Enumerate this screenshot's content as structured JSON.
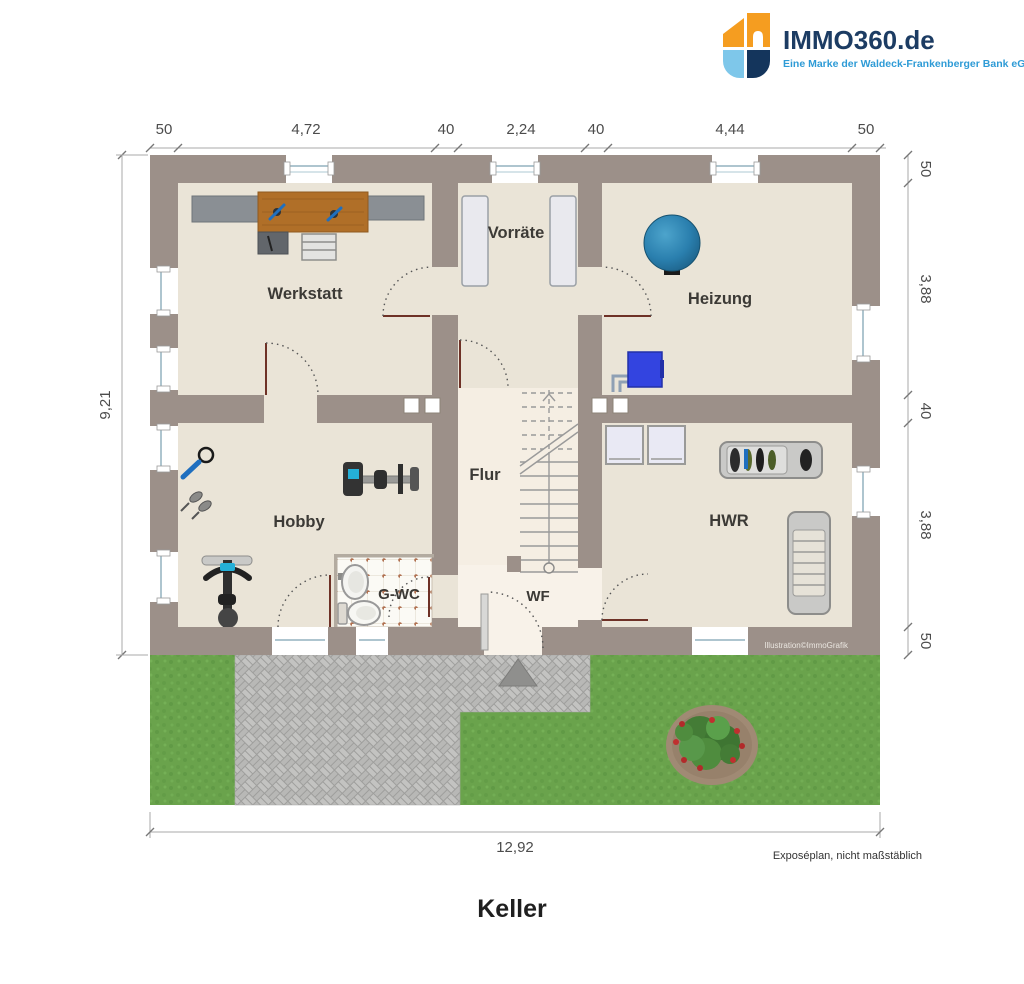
{
  "header": {
    "brand": "IMMO360.de",
    "tagline": "Eine Marke der Waldeck-Frankenberger Bank eG"
  },
  "plan": {
    "rooms": {
      "werkstatt": "Werkstatt",
      "vorraete": "Vorräte",
      "heizung": "Heizung",
      "flur": "Flur",
      "hobby": "Hobby",
      "gwc": "G-WC",
      "wf": "WF",
      "hwr": "HWR"
    },
    "copyright": "Illustration©ImmoGrafik",
    "icons": [
      "storage-tank",
      "boiler",
      "workbench",
      "step-ladder",
      "exercise-bike",
      "rowing-machine",
      "washer",
      "dryer",
      "drying-rack-full",
      "drying-rack-empty",
      "sink",
      "toilet",
      "staircase",
      "entrance-arrow",
      "bush",
      "shelf"
    ]
  },
  "dimensions": {
    "top": [
      "50",
      "4,72",
      "40",
      "2,24",
      "40",
      "4,44",
      "50"
    ],
    "right": [
      "50",
      "3,88",
      "40",
      "3,88",
      "50"
    ],
    "left": [
      "9,21"
    ],
    "bottom": [
      "12,92"
    ]
  },
  "footer": {
    "note": "Exposéplan, nicht maßstäblich",
    "floor_title": "Keller"
  },
  "colors": {
    "brand_navy": "#1c3c63",
    "brand_blue": "#2e9bd6",
    "brand_orange": "#f59d20",
    "brand_lightblue": "#7ec7ea",
    "wall": "#9c9089",
    "floor": "#eae4d7",
    "floor_light": "#f5eee3",
    "grass": "#6aa34c",
    "paving": "#b9b9b7",
    "door_swing_line": "#6e3126",
    "tank_blue": "#2a7fae",
    "boiler_blue": "#3344e0"
  }
}
